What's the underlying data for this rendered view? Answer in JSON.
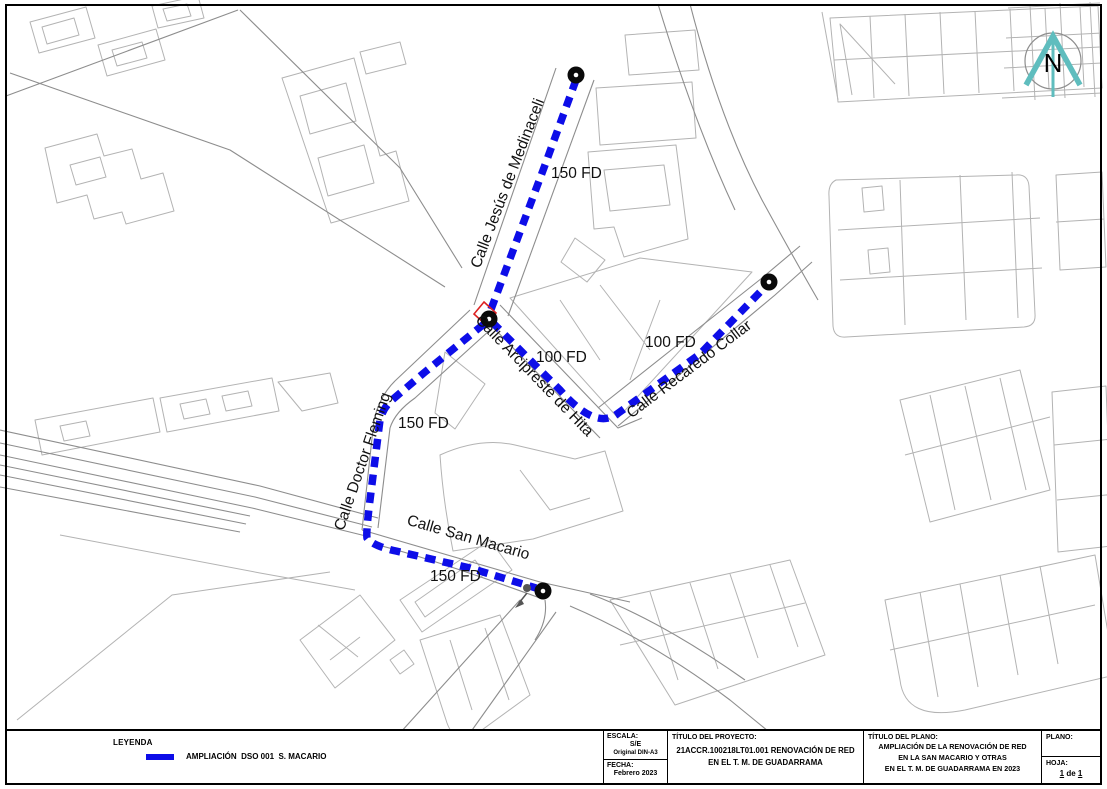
{
  "map": {
    "route_color": "#0d0de8",
    "street_labels": [
      {
        "text": "Calle Jesús de Medinaceli"
      },
      {
        "text": "Calle Arcipreste de Hita"
      },
      {
        "text": "Calle Recaredo Collar"
      },
      {
        "text": "Calle Doctor Fleming"
      },
      {
        "text": "Calle San Macario"
      }
    ],
    "distance_labels": [
      {
        "text": "150 FD"
      },
      {
        "text": "100 FD"
      },
      {
        "text": "100 FD"
      },
      {
        "text": "150 FD"
      },
      {
        "text": "150 FD"
      }
    ],
    "north_label": "N",
    "compass_color": "#5fbdbe"
  },
  "legend": {
    "title": "LEYENDA",
    "item_label": "AMPLIACIÓN  DSO 001  S. MACARIO",
    "item_color": "#0d0de8"
  },
  "titleblock": {
    "escala_label": "ESCALA:",
    "escala_value": "S/E",
    "original_format": "Original DIN-A3",
    "fecha_label": "FECHA:",
    "fecha_value": "Febrero 2023",
    "proyecto_label": "TÍTULO DEL PROYECTO:",
    "proyecto_line1": "21ACCR.100218LT01.001 RENOVACIÓN DE RED",
    "proyecto_line2": "EN EL T. M. DE GUADARRAMA",
    "plano_label": "TÍTULO DEL PLANO:",
    "plano_line1": "AMPLIACIÓN DE LA RENOVACIÓN DE RED",
    "plano_line2": "EN LA SAN MACARIO Y OTRAS",
    "plano_line3": "EN EL T. M. DE GUADARRAMA EN 2023",
    "plano_num_label": "PLANO:",
    "hoja_label": "HOJA:",
    "hoja_page": "1",
    "hoja_sep": "de",
    "hoja_total": "1"
  }
}
